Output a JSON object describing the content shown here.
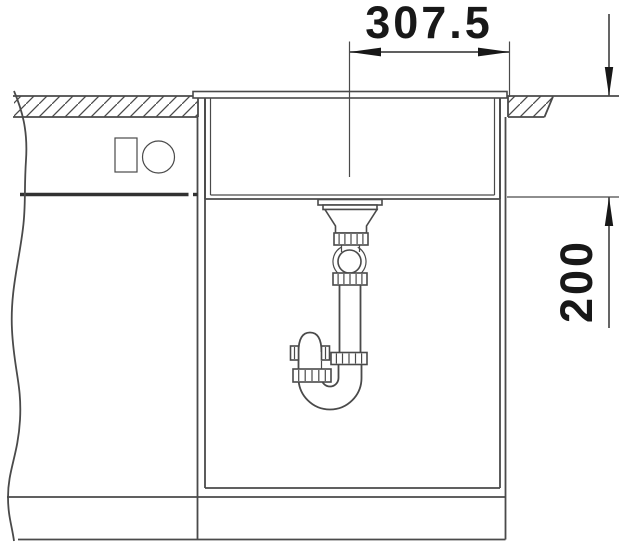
{
  "page": {
    "background": "#ffffff",
    "kind": "sink installation cross-section drawing"
  },
  "colors": {
    "line-color": "#4a4a4a",
    "dark-line-color": "#323232",
    "text-color": "#181818",
    "bg-color": "#ffffff"
  },
  "dimensions": {
    "top_label": "307.5",
    "right_label": "200"
  }
}
